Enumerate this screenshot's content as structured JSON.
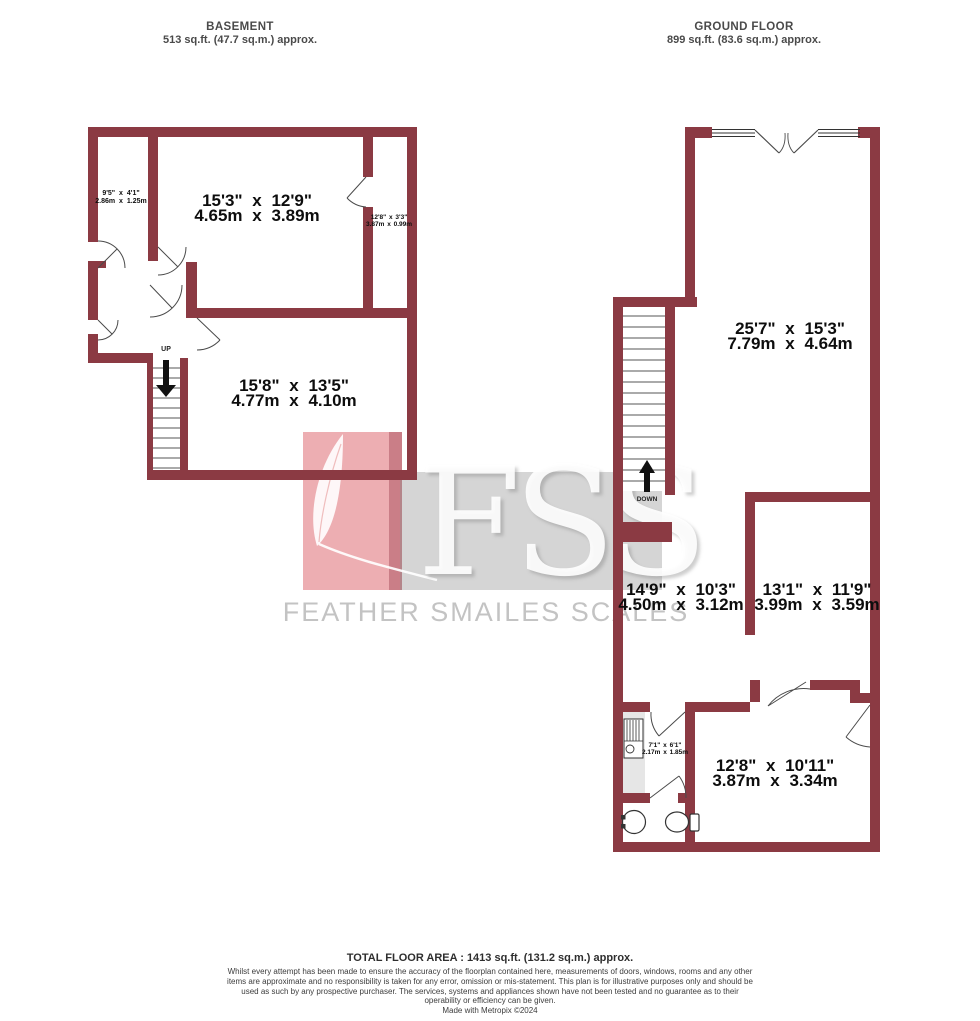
{
  "basement": {
    "title": "BASEMENT",
    "area_label": "513 sq.ft. (47.7 sq.m.) approx.",
    "stairs_label": "UP",
    "rooms": [
      {
        "imperial": "9'5\" x 4'1\"",
        "metric": "2.86m x 1.25m"
      },
      {
        "imperial": "15'3\" x 12'9\"",
        "metric": "4.65m x 3.89m"
      },
      {
        "imperial": "12'8\" x 3'3\"",
        "metric": "3.87m x 0.99m"
      },
      {
        "imperial": "15'8\" x 13'5\"",
        "metric": "4.77m x 4.10m"
      }
    ]
  },
  "ground_floor": {
    "title": "GROUND FLOOR",
    "area_label": "899 sq.ft. (83.6 sq.m.) approx.",
    "stairs_label": "DOWN",
    "rooms": [
      {
        "imperial": "25'7\" x 15'3\"",
        "metric": "7.79m x 4.64m"
      },
      {
        "imperial": "14'9\" x 10'3\"",
        "metric": "4.50m x 3.12m"
      },
      {
        "imperial": "13'1\" x 11'9\"",
        "metric": "3.99m x 3.59m"
      },
      {
        "imperial": "7'1\" x 6'1\"",
        "metric": "2.17m x 1.85m"
      },
      {
        "imperial": "12'8\" x 10'11\"",
        "metric": "3.87m x 3.34m"
      }
    ]
  },
  "watermark": {
    "initials": "FSS",
    "name": "FEATHER SMAILES SCALES"
  },
  "footer": {
    "total_area": "TOTAL FLOOR AREA : 1413 sq.ft. (131.2 sq.m.) approx.",
    "disclaimer": "Whilst every attempt has been made to ensure the accuracy of the floorplan contained here, measurements of doors, windows, rooms and any other items are approximate and no responsibility is taken for any error, omission or mis-statement. This plan is for illustrative purposes only and should be used as such by any prospective purchaser. The services, systems and appliances shown have not been tested and no guarantee as to their operability or efficiency can be given.",
    "credit": "Made with Metropix ©2024"
  },
  "colors": {
    "wall": "#8B3A43",
    "line": "#4a4a4a",
    "watermark_red": "#CE1E2A",
    "watermark_grey": "#919191"
  }
}
